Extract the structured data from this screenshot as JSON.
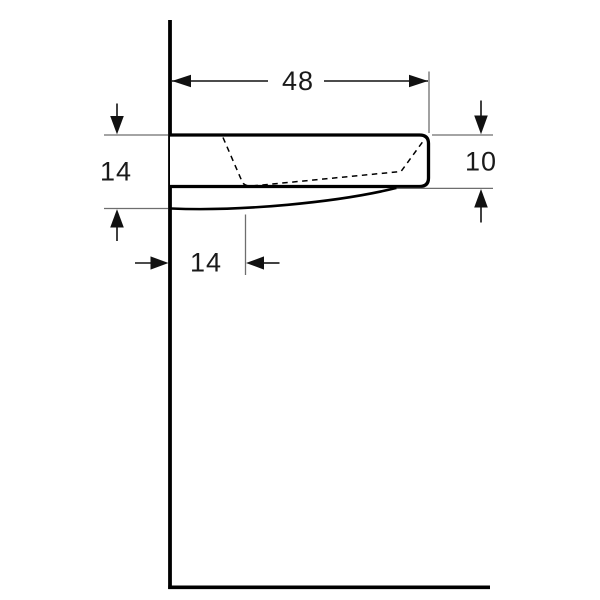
{
  "diagram": {
    "description": "Side-view technical dimension drawing of a wall-mounted washbasin",
    "dimensions": {
      "top_width": {
        "label": "48"
      },
      "right_front_height": {
        "label": "10"
      },
      "left_wall_height": {
        "label": "14"
      },
      "bottom_offset": {
        "label": "14"
      }
    },
    "colors": {
      "background": "#ffffff",
      "object_line": "#000000",
      "dimension_line": "#111111",
      "extension_line": "#6e6e6e",
      "text": "#1a1a1a"
    }
  }
}
